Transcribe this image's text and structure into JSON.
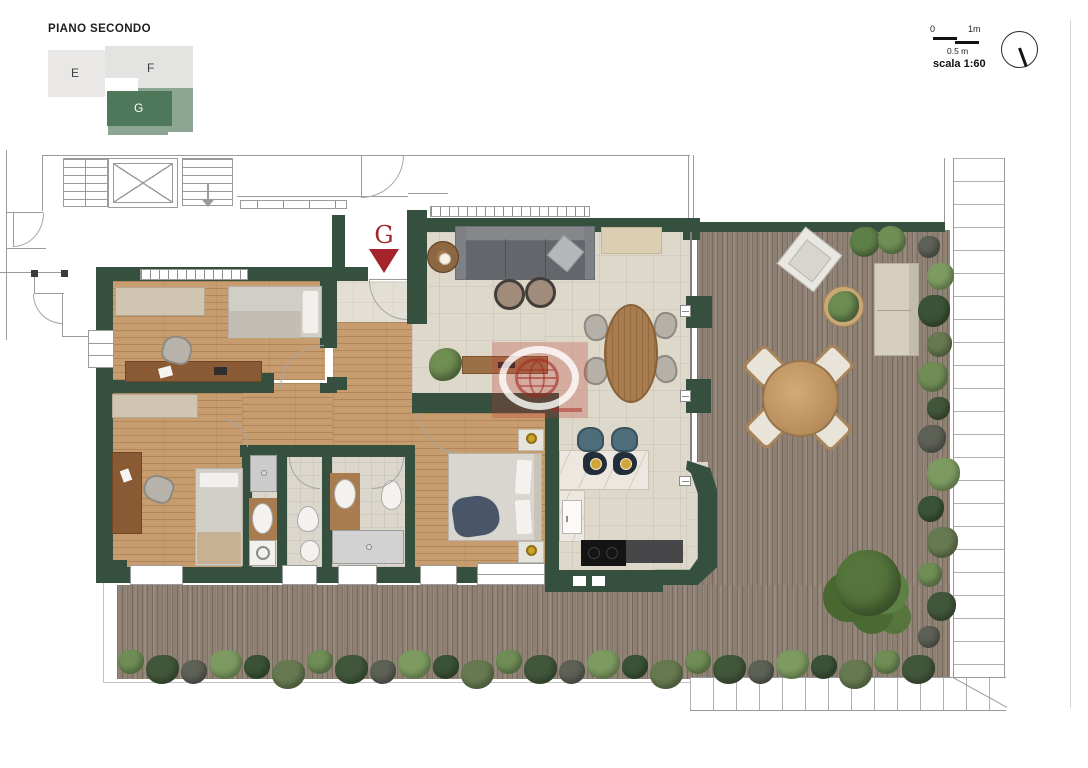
{
  "header": {
    "title": "PIANO SECONDO"
  },
  "key_plan": {
    "units": [
      {
        "label": "E",
        "highlighted": false
      },
      {
        "label": "F",
        "highlighted": false
      },
      {
        "label": "G",
        "highlighted": true
      }
    ]
  },
  "scale_bar": {
    "zero": "0",
    "one_meter": "1m",
    "half_meter": "0.5 m",
    "scale_text": "scala 1:60"
  },
  "entrance_marker": {
    "label": "G"
  },
  "colors": {
    "wall_green": "#35503f",
    "key_plan_green": "#4f7759",
    "key_plan_green_light": "#8da694",
    "marker_red": "#a3242a",
    "deck_wood": "#8e8073",
    "interior_wood": "#c79d6f"
  }
}
